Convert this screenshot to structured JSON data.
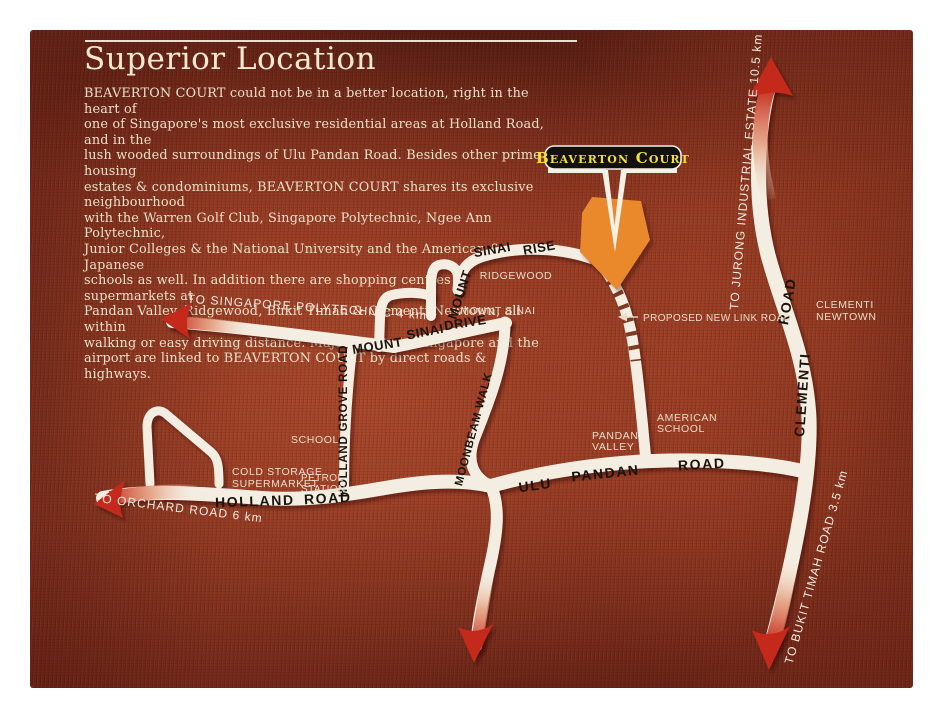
{
  "page": {
    "title": "Superior Location",
    "body_lines": [
      "BEAVERTON COURT could not be in a better location, right in the heart of",
      "one of Singapore's most exclusive residential areas at Holland Road, and in the",
      "lush wooded surroundings of Ulu Pandan Road. Besides other prime housing",
      "estates & condominiums, BEAVERTON COURT shares its exclusive neighbourhood",
      "with the Warren Golf Club, Singapore Polytechnic, Ngee Ann Polytechnic,",
      "Junior Colleges & the National University and the American & Japanese",
      "schools as well. In addition there are shopping centres & supermarkets at",
      "Pandan Valley, Ridgewood, Bukit Timah & Clementi Newtown, all within",
      "walking or easy driving distance. Major points in Singapore and the",
      "airport are linked to BEAVERTON COURT by direct roads & highways."
    ]
  },
  "marker": {
    "label": "Beaverton Court"
  },
  "roads": {
    "rise_w1": "MOUNT",
    "rise_w2": "SINAI",
    "rise_w3": "RISE",
    "drive_w1": "MOUNT",
    "drive_w2": "SINAI",
    "drive_w3": "DRIVE",
    "holland_grove": "HOLLAND GROVE ROAD",
    "moonbeam": "MOONBEAM WALK",
    "holland_w1": "HOLLAND",
    "holland_w2": "ROAD",
    "ulu_w1": "ULU",
    "ulu_w2": "PANDAN",
    "ulu_w3": "ROAD",
    "clementi_w1": "CLEMENTI",
    "clementi_w2": "ROAD"
  },
  "places": {
    "ridgewood": "RIDGEWOOD",
    "mount_sinai": "MOUNT SINAI",
    "proposed_link": "PROPOSED NEW LINK ROAD",
    "school": "SCHOOL",
    "cold_storage_1": "COLD STORAGE",
    "cold_storage_2": "SUPERMARKET",
    "petrol_1": "PETROL",
    "petrol_2": "STATION",
    "pandan_1": "PANDAN",
    "pandan_2": "VALLEY",
    "american_1": "AMERICAN",
    "american_2": "SCHOOL",
    "clementi_new_1": "CLEMENTI",
    "clementi_new_2": "NEWTOWN"
  },
  "directions": {
    "polytechnic": "TO SINGAPORE POLYTECHNIC 4 km",
    "orchard": "TO ORCHARD ROAD 6 km",
    "jurong": "TO JURONG INDUSTRIAL ESTATE 10.5 km",
    "bukit_timah": "TO BUKIT TIMAH ROAD 3.5 km"
  },
  "colors": {
    "map_background": "#86301d",
    "road": "#f4eee2",
    "arrow_red": "#c4291b",
    "site_orange": "#e9892c",
    "plate_black": "#14100d",
    "plate_yellow": "#f0e03c"
  }
}
